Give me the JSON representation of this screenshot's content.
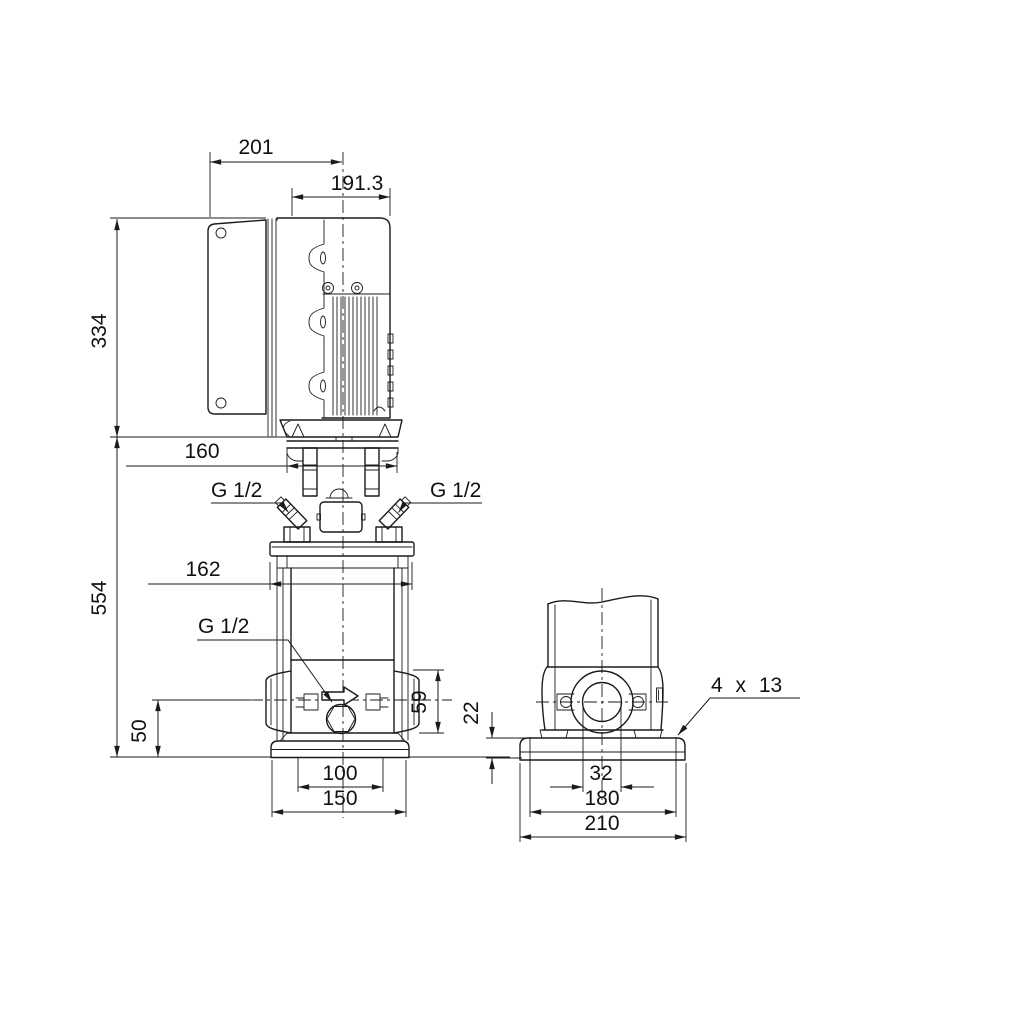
{
  "meta": {
    "description": "Technical dimensional drawing of a vertical multistage pump with motor, side view and end view",
    "background_color": "#ffffff",
    "line_color": "#1b1b1b"
  },
  "views": {
    "side": {
      "label": "side-elevation-view",
      "dims": {
        "width_top": "201",
        "width_motor": "191.3",
        "height_motor": "334",
        "height_pump": "554",
        "width_coupling": "160",
        "width_flange": "162",
        "port_left": "G 1/2",
        "port_right": "G 1/2",
        "port_drain": "G 1/2",
        "height_port": "50",
        "height_base": "59",
        "hole_spacing": "100",
        "base_width": "150"
      }
    },
    "end": {
      "label": "end-elevation-view",
      "dims": {
        "plate_thickness": "22",
        "mounting_holes": "4 x 13",
        "port_bore": "32",
        "hole_spacing": "180",
        "plate_width": "210"
      }
    }
  }
}
